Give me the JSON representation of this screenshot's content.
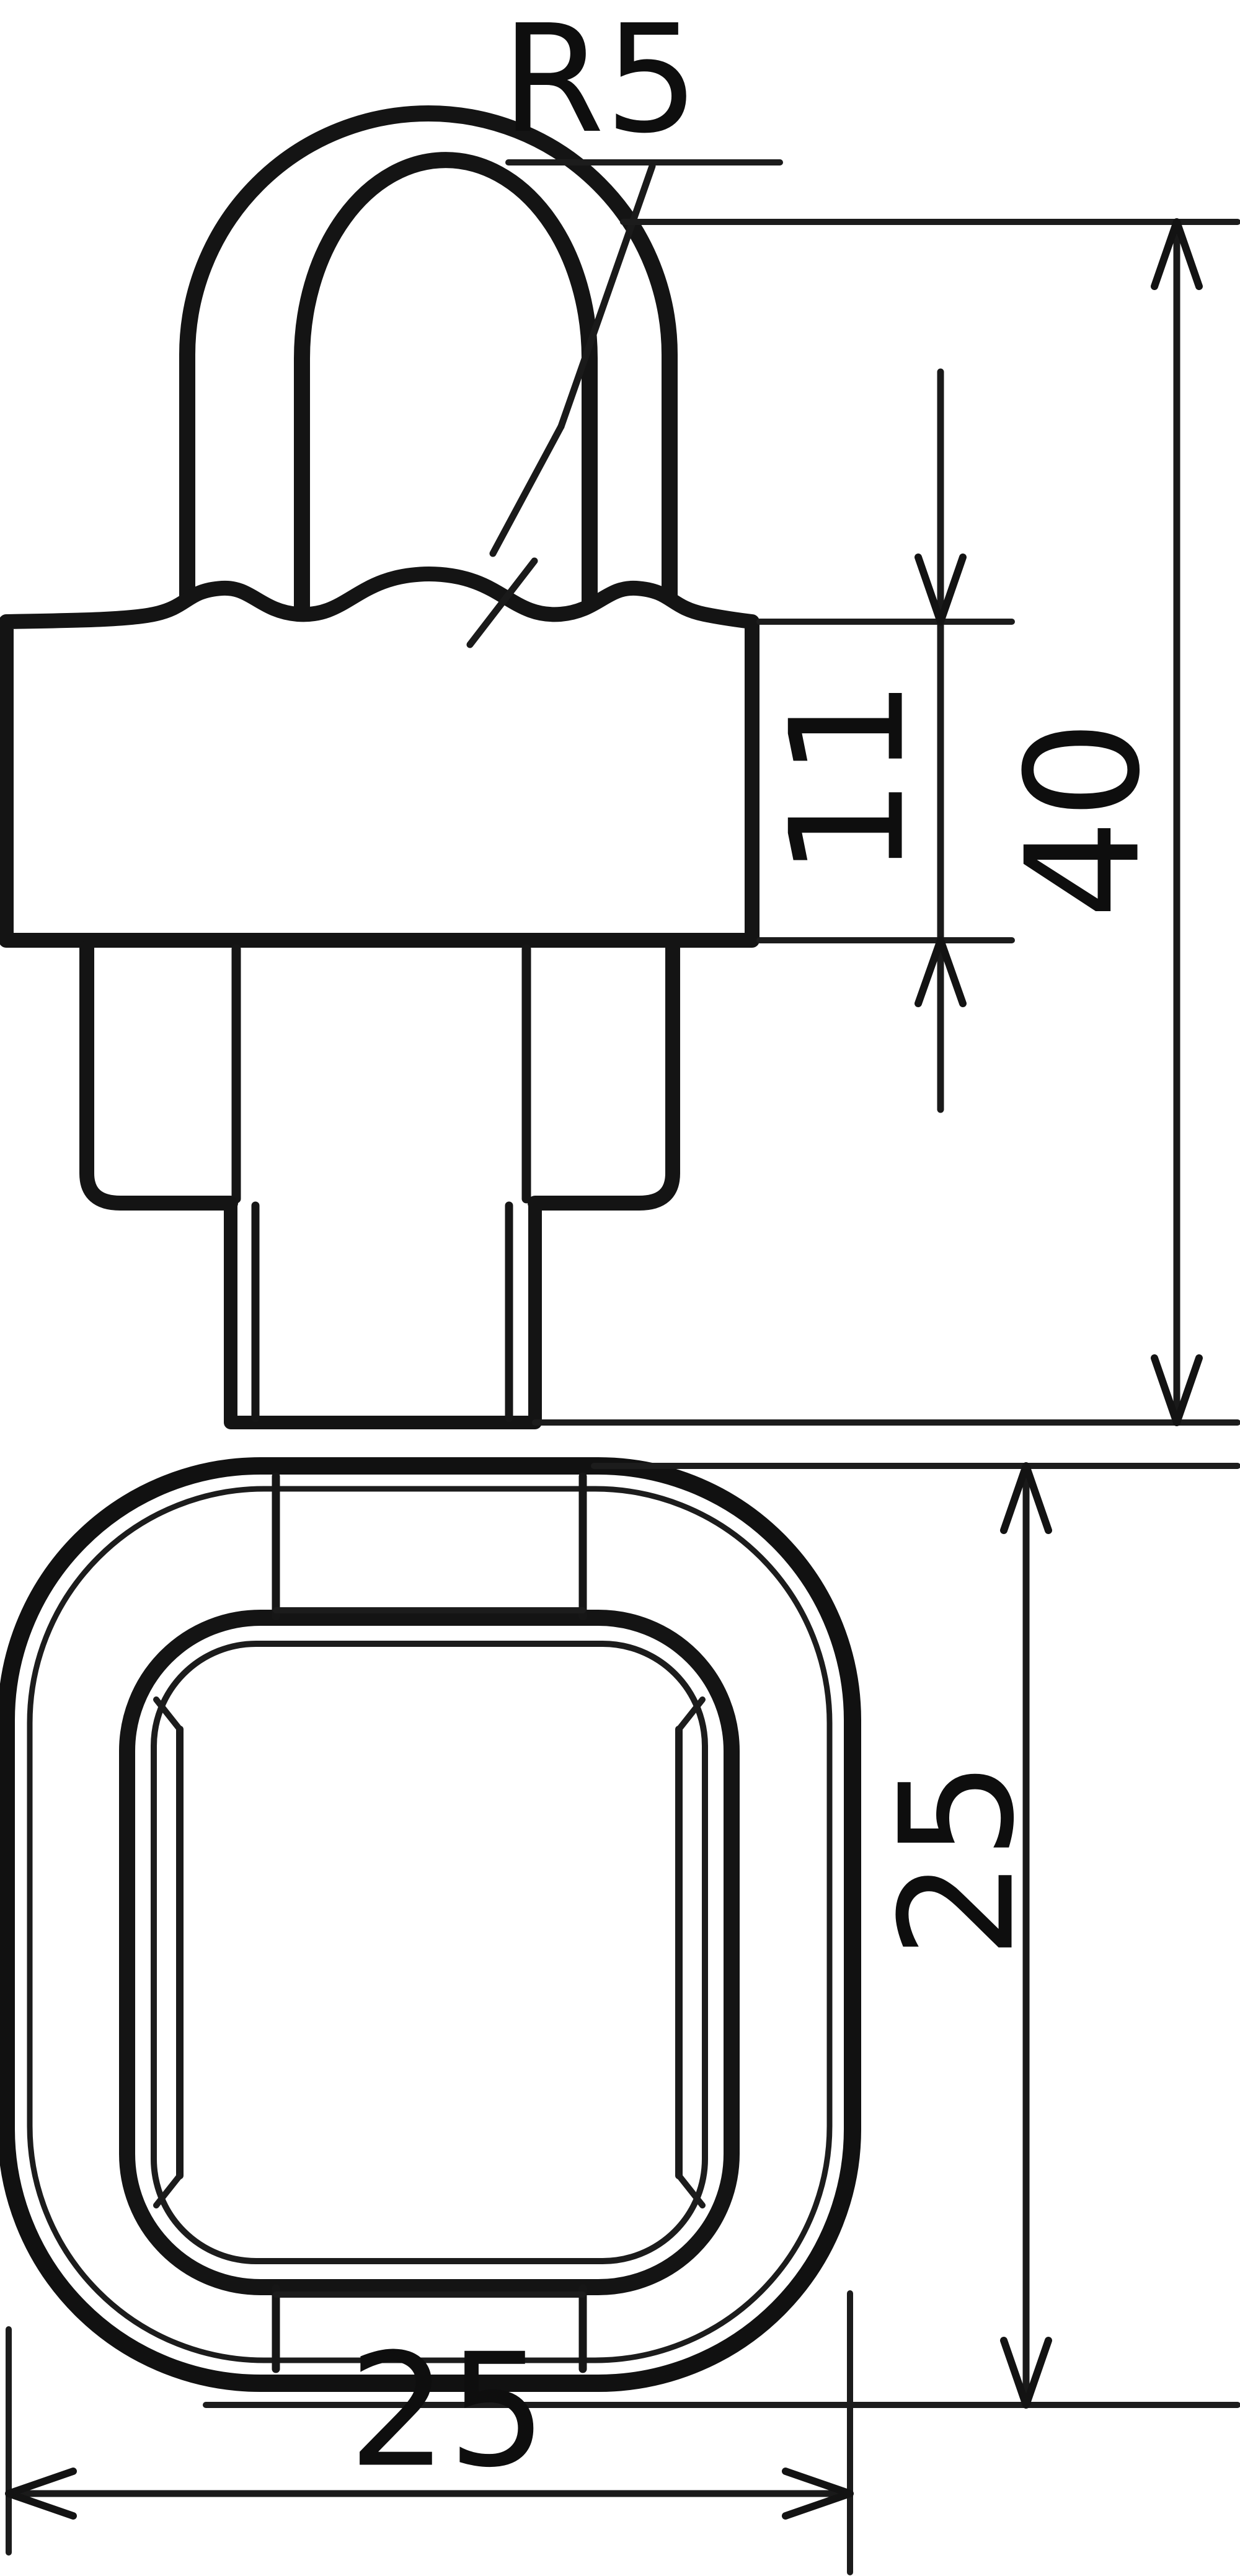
{
  "drawing": {
    "type": "technical-dimension-drawing",
    "background": "#ffffff",
    "line_color": "#141414",
    "dimensions": {
      "fillet_radius_label": "R5",
      "body_height_label": "11",
      "overall_height_label": "40",
      "top_view_height_label": "25",
      "top_view_width_label": "25"
    }
  }
}
